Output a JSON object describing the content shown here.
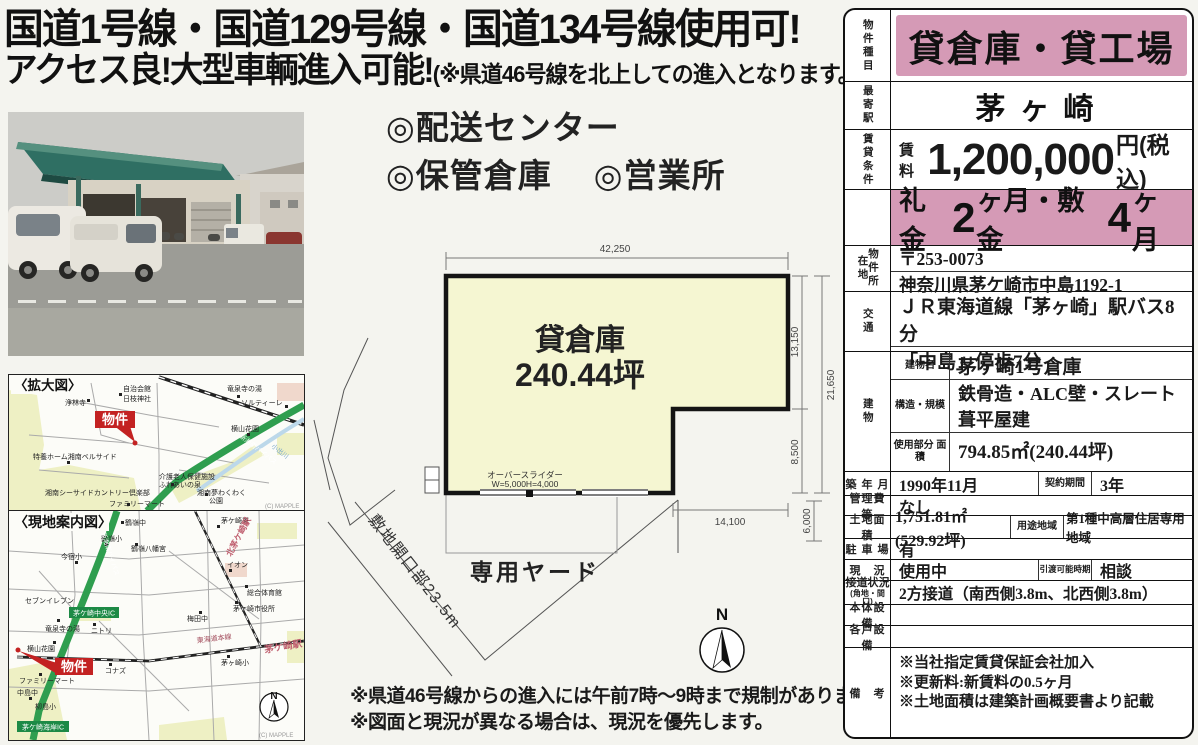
{
  "colors": {
    "pink_band": "#d59ab6",
    "plan_fill": "#f5f6d2",
    "highway_green": "#2f9e4f",
    "badge_green": "#1d8a46",
    "marker_red": "#c32222",
    "station_text": "#c06070",
    "map_pale": "#eef0c4"
  },
  "headline": {
    "line1": "国道1号線・国道129号線・国道134号線使用可!",
    "line2": "アクセス良!大型車輌進入可能!",
    "line2_note": "(※県道46号線を北上しての進入となります。)"
  },
  "uses": {
    "item1": "◎配送センター",
    "item2": "◎保管倉庫",
    "item3": "◎営業所"
  },
  "notes": {
    "line1": "※県道46号線からの進入には午前7時～9時まで規制があります。",
    "line2": "※図面と現況が異なる場合は、現況を優先します。"
  },
  "plan": {
    "building_label": "貸倉庫",
    "building_area": "240.44坪",
    "dim_top": "42,250",
    "dim_right_upper": "13,150",
    "dim_right_total": "21,650",
    "dim_right_lower": "8,500",
    "dim_right_bottom": "6,000",
    "dim_bottom": "14,100",
    "door_line1": "オーバースライダー",
    "door_line2": "W=5,000H=4,000",
    "yard_label": "専用ヤード",
    "frontage_label": "敷地開口部23.5m",
    "compass": "N"
  },
  "maps": {
    "enlarged": {
      "title": "〈拡大図〉",
      "marker": "物件",
      "credit": "(C) MAPPLE",
      "labels": {
        "temple": "浄林寺",
        "hall": "自治会館",
        "shrine": "日枝神社",
        "onsen": "竜泉寺の湯",
        "sortile": "ソルティーレ",
        "garden": "横山花園",
        "home": "特養ホーム湘南ベルサイド",
        "care1": "介護老人保健施設",
        "care2": "ふれあいの泉",
        "golf": "湘南シーサイドカントリー倶楽部",
        "conv": "ファミリーマート",
        "park1": "湘南夢わくわく",
        "park2": "公園",
        "bypass": "新湘南バイパス",
        "river": "小出川"
      }
    },
    "guide": {
      "title": "〈現地案内図〉",
      "marker": "物件",
      "credit": "(C) MAPPLE",
      "compass": "N",
      "labels": {
        "tsurumine_jhs": "鶴嶺中",
        "tsurumine_es": "鶴嶺小",
        "hachimangu": "鶴嶺八幡宮",
        "imajuku_es": "今宿小",
        "seven": "セブンイレブン",
        "chuo_ic": "茅ケ崎中央IC",
        "onsen": "竜泉寺の湯",
        "nitori": "ニトリ",
        "garden": "横山花園",
        "conv": "ファミリーマート",
        "nakajima_jhs": "中島中",
        "yanagishima_es": "柳島小",
        "konaz": "コナズ",
        "kaigan_ic": "茅ケ崎海岸IC",
        "aeon": "イオン",
        "gym": "総合体育館",
        "city_hall": "茅ケ崎市役所",
        "umeda_jhs": "梅田中",
        "chigasaki_es": "茅ヶ崎小",
        "police": "茅ケ崎署",
        "kita_station": "北茅ケ崎駅",
        "station": "茅ケ崎駅",
        "tokaido_line": "東海道本線",
        "bypass": "新湘南バイパス"
      }
    }
  },
  "panel": {
    "property_type": {
      "label": "物件種目",
      "value": "貸倉庫・貸工場"
    },
    "station": {
      "label": "最寄駅",
      "value": "茅ヶ崎"
    },
    "terms": {
      "label": "賃貸条件",
      "rent_label": "賃料",
      "rent_value": "1,200,000",
      "rent_unit": "円(税込)",
      "key1": "礼金",
      "key1_num": "2",
      "key_mid": "ヶ月・敷金",
      "key2_num": "4",
      "key_end": "ヶ月"
    },
    "location": {
      "label": "物件所在地",
      "postal": "〒253-0073",
      "address": "神奈川県茅ケ崎市中島1192-1"
    },
    "access": {
      "label": "交通",
      "line1": "ＪＲ東海道線「茅ヶ崎」駅バス8分",
      "line2": "「中島」停歩7分"
    },
    "building": {
      "label": "建物",
      "name_label": "建物名",
      "name": "茅ヶ崎1号倉庫",
      "structure_label": "構造・規模",
      "structure": "鉄骨造・ALC壁・スレート葺平屋建",
      "area_label": "使用部分 面積",
      "area": "794.85㎡(240.44坪)"
    },
    "built": {
      "label": "築 年 月",
      "value": "1990年11月",
      "term_label": "契約期間",
      "term": "3年"
    },
    "fee": {
      "label": "管理費等",
      "value": "なし"
    },
    "land": {
      "label": "土地面積",
      "value": "1,751.81㎡(529.92坪)",
      "zone_label": "用途地域",
      "zone": "第1種中高層住居専用地域"
    },
    "parking": {
      "label": "駐 車 場",
      "value": "有"
    },
    "status": {
      "label": "現　況",
      "value": "使用中",
      "handover_label": "引渡可能時期",
      "handover": "相談"
    },
    "road": {
      "label": "接道状況",
      "label2": "(角地・間口)",
      "value": "2方接道（南西側3.8m、北西側3.8m）"
    },
    "equip_main": {
      "label": "本体設備",
      "value": ""
    },
    "equip_unit": {
      "label": "各戸設備",
      "value": ""
    },
    "remarks": {
      "label": "備　考",
      "line1": "※当社指定賃貸保証会社加入",
      "line2": "※更新料:新賃料の0.5ヶ月",
      "line3": "※土地面積は建築計画概要書より記載"
    }
  }
}
